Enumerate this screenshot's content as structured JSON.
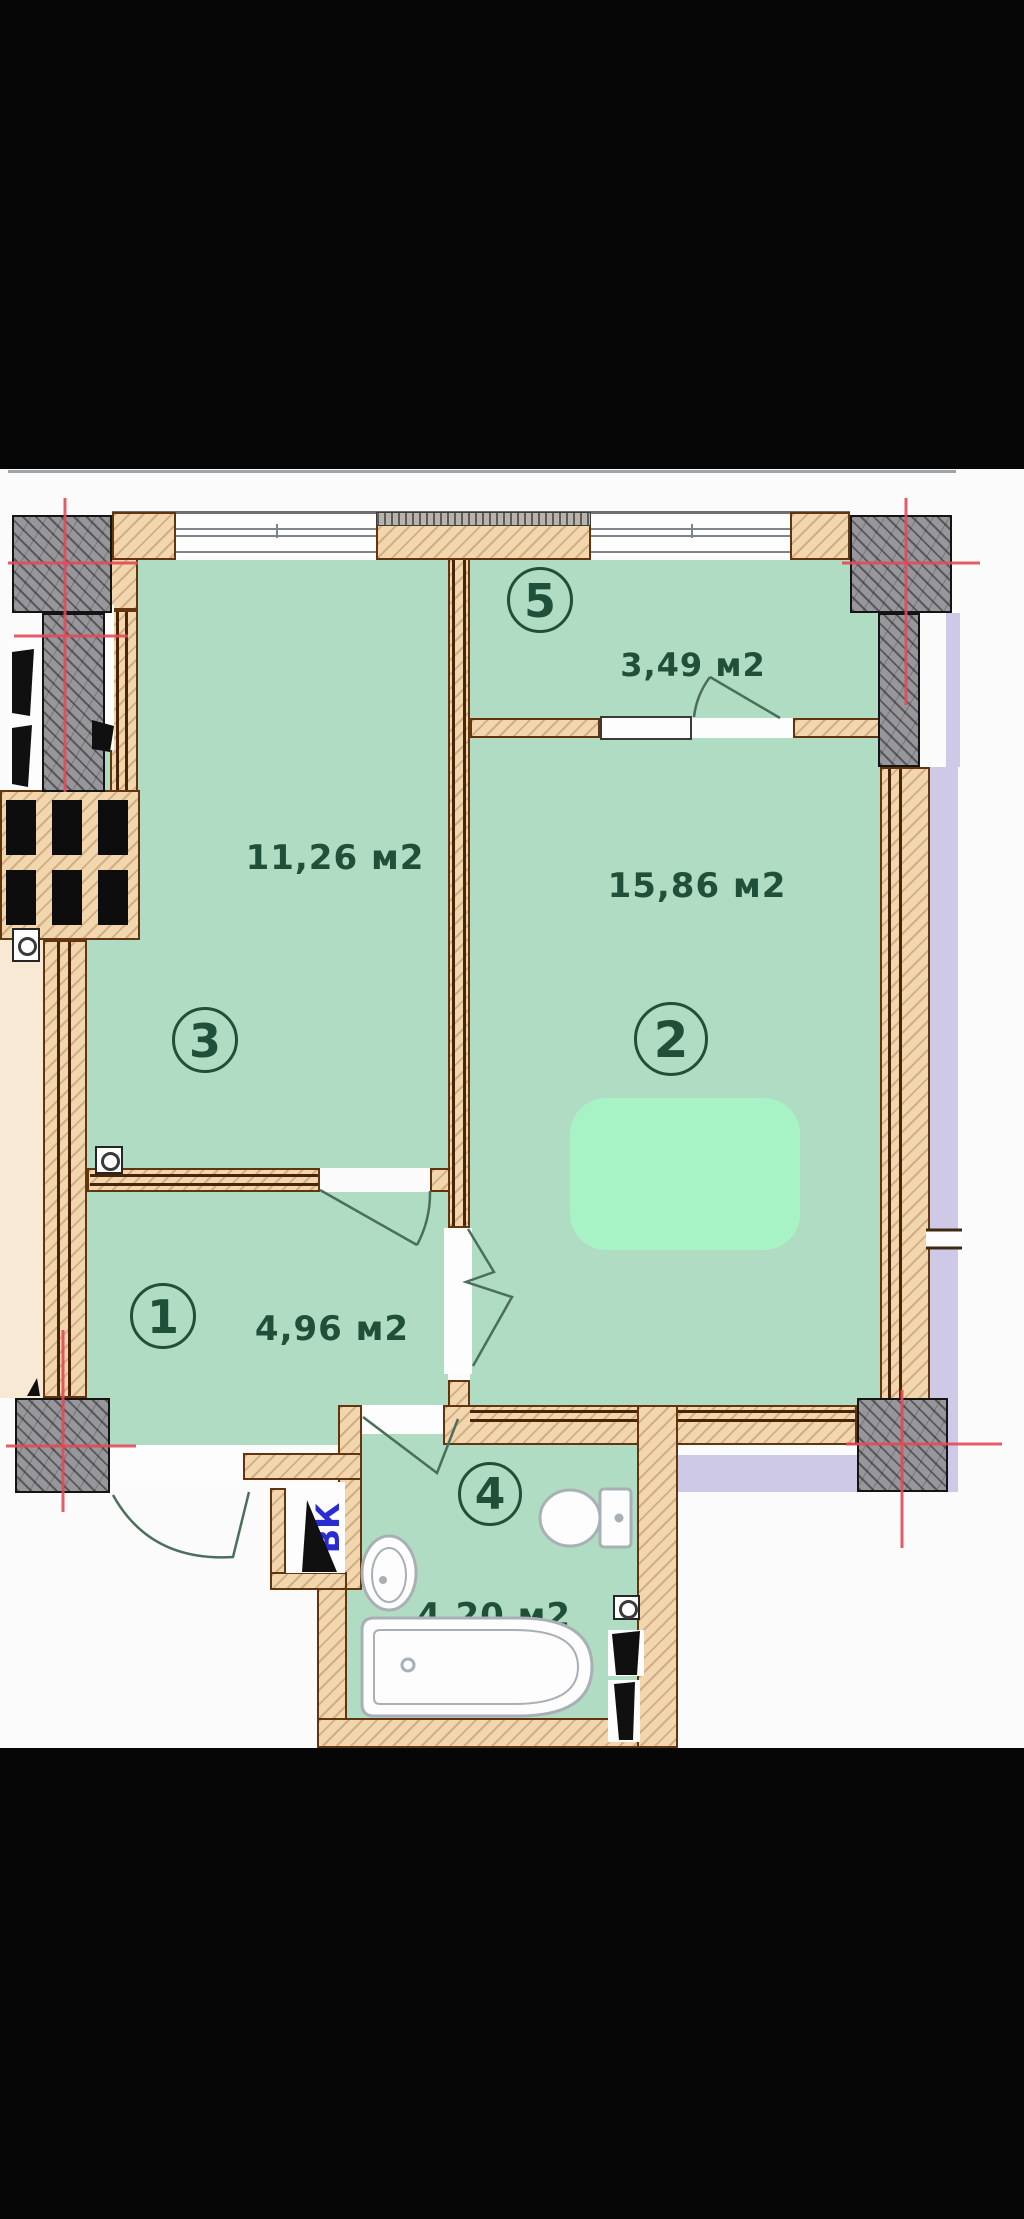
{
  "plan": {
    "rooms": [
      {
        "number": "1",
        "area": "4,96 м2"
      },
      {
        "number": "2",
        "area": "15,86 м2"
      },
      {
        "number": "3",
        "area": "11,26 м2"
      },
      {
        "number": "4",
        "area": "4,20 м2"
      },
      {
        "number": "5",
        "area": "3,49 м2"
      }
    ],
    "shaft_label": "ВК",
    "colors": {
      "room_fill": "#afdcc2",
      "furniture_fill": "#a7f3c6",
      "wall_fill": "#f1d6ae",
      "wall_outline": "#63350f",
      "column_fill": "#97969a",
      "outside_band": "#cfc9e8",
      "adjacent_band": "#f8e9d4",
      "label_text": "#20503a",
      "shaft_text": "#2b2bd4",
      "axis_cross": "#e24b58"
    }
  }
}
